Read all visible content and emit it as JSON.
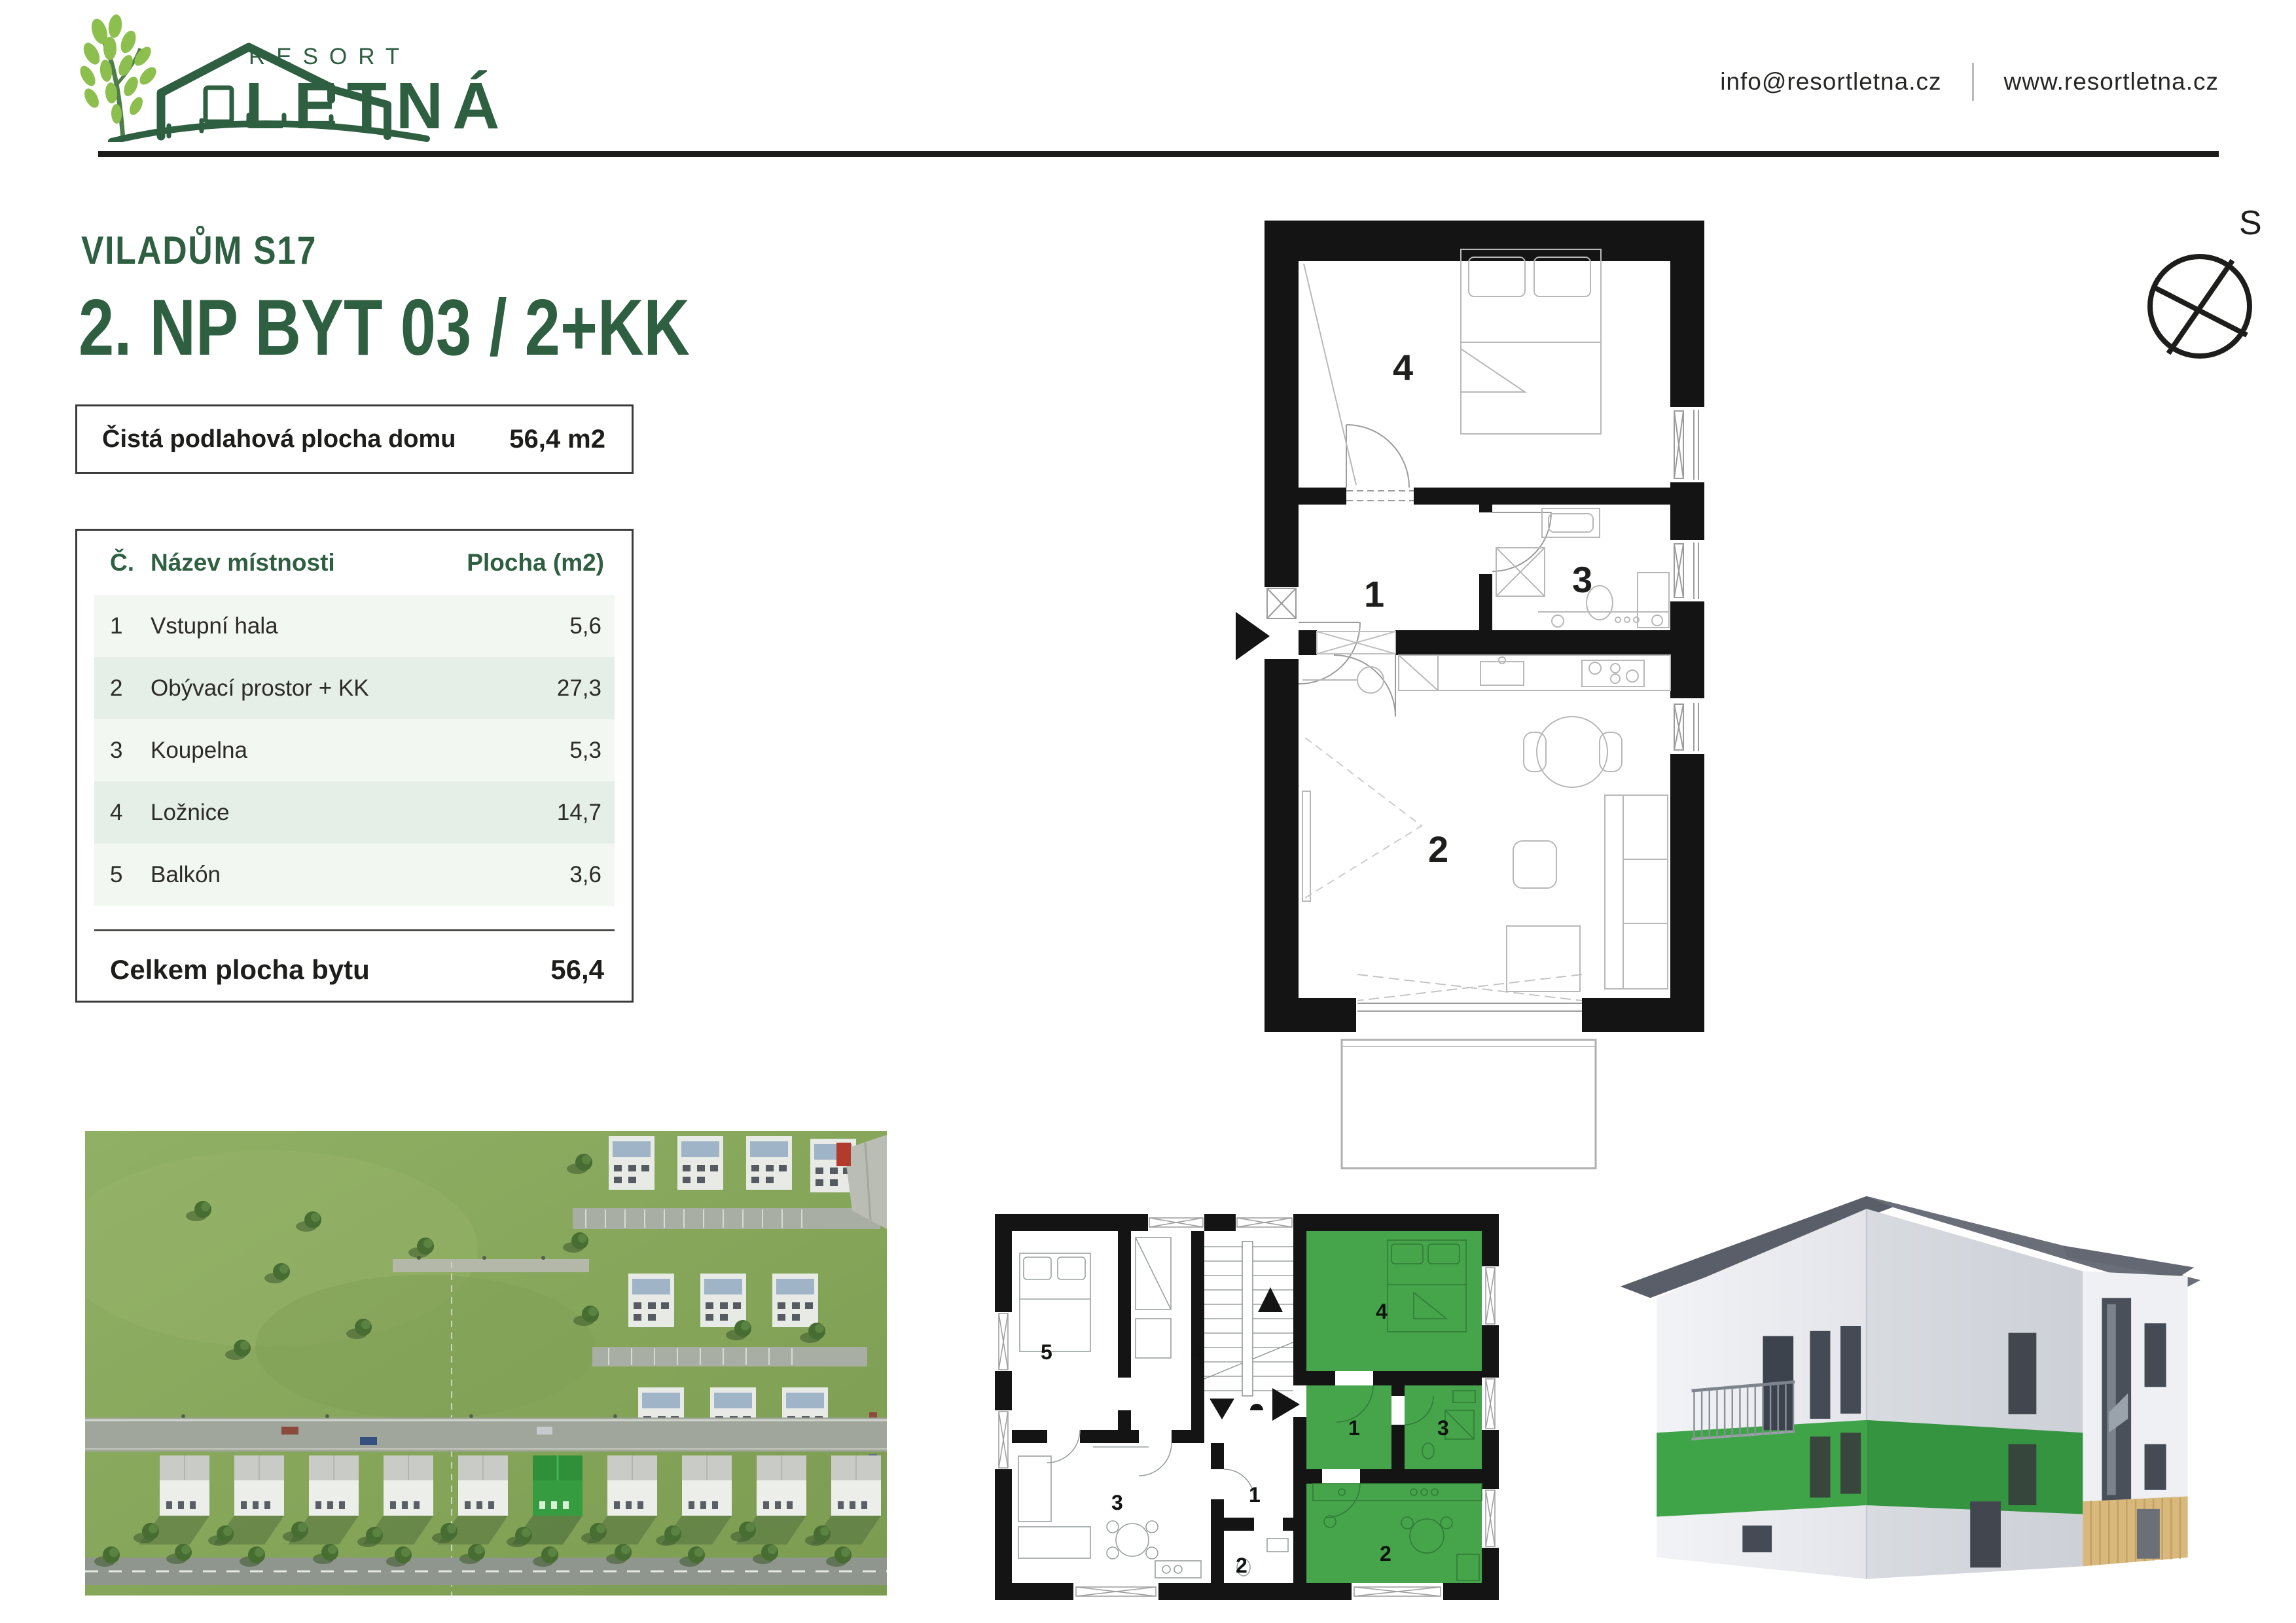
{
  "header": {
    "brand": {
      "word1": "RESORT",
      "word2": "LETNÁ"
    },
    "email": "info@resortletna.cz",
    "website": "www.resortletna.cz"
  },
  "titles": {
    "building": "VILADŮM S17",
    "apartment": "2. NP BYT 03 / 2+KK"
  },
  "summary_box": {
    "label": "Čistá podlahová plocha domu",
    "value": "56,4 m2"
  },
  "rooms_table": {
    "headers": {
      "num": "Č.",
      "name": "Název místnosti",
      "area": "Plocha (m2)"
    },
    "rows": [
      {
        "num": "1",
        "name": "Vstupní hala",
        "area": "5,6"
      },
      {
        "num": "2",
        "name": "Obývací prostor + KK",
        "area": "27,3"
      },
      {
        "num": "3",
        "name": "Koupelna",
        "area": "5,3"
      },
      {
        "num": "4",
        "name": "Ložnice",
        "area": "14,7"
      },
      {
        "num": "5",
        "name": "Balkón",
        "area": "3,6"
      }
    ],
    "total": {
      "label": "Celkem plocha bytu",
      "value": "56,4"
    }
  },
  "compass": {
    "letter": "S"
  },
  "plan_main": {
    "labels": {
      "r1": "1",
      "r2": "2",
      "r3": "3",
      "r4": "4"
    }
  },
  "plan_small": {
    "left": {
      "r5": "5",
      "r4": "4",
      "r1": "1",
      "r3": "3",
      "r2": "2"
    },
    "right": {
      "r4": "4",
      "r1": "1",
      "r3": "3",
      "r2": "2"
    }
  },
  "colors": {
    "brand_green": "#2e5f41",
    "leaf_green": "#8cbf4e",
    "highlight_green": "#46a44b",
    "band_green": "#3ea447"
  }
}
